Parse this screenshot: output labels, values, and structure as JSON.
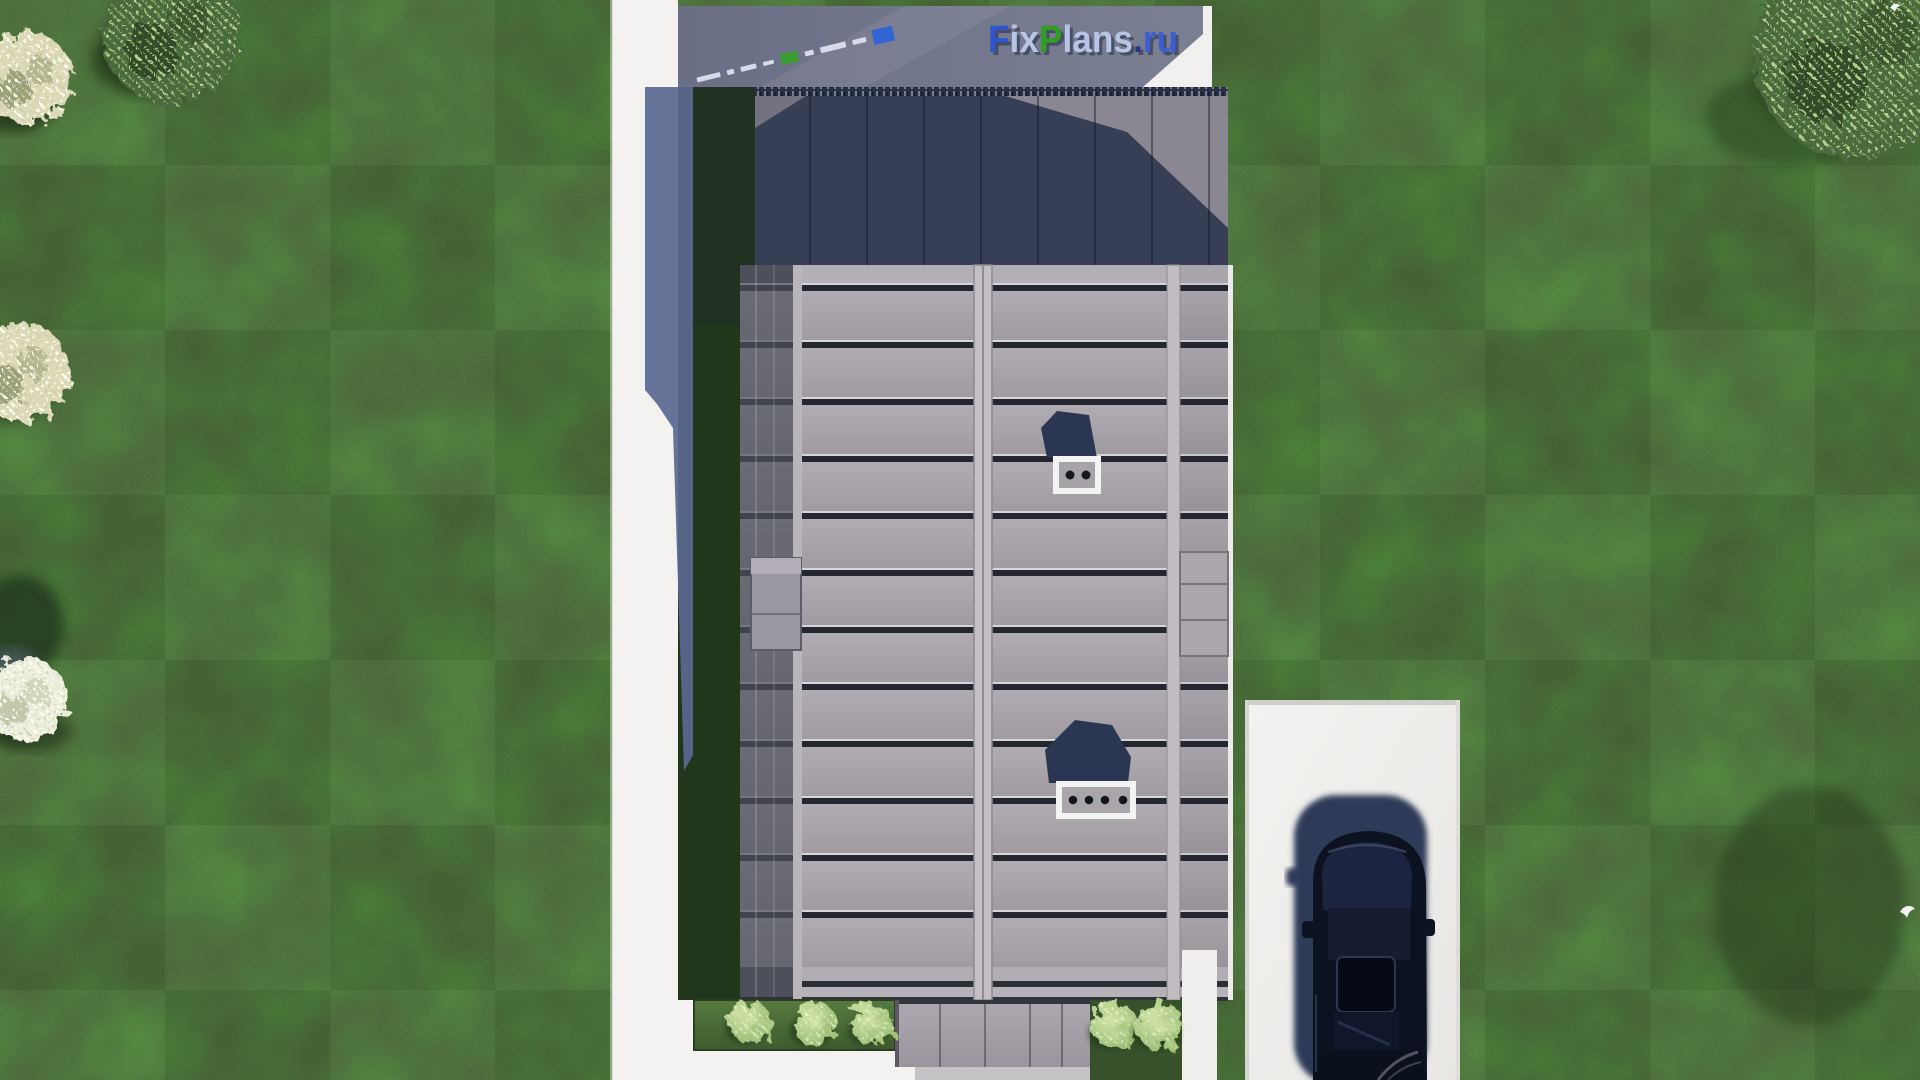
{
  "watermark": {
    "text": "FixPlans.ru",
    "segments": [
      {
        "text": "F",
        "color": "#2e55cc"
      },
      {
        "text": "ix",
        "color": "#b8c4e4"
      },
      {
        "text": "P",
        "color": "#2f9e22"
      },
      {
        "text": "lans",
        "color": "#b8c4e4"
      },
      {
        "text": ".",
        "color": "#26387d"
      },
      {
        "text": "ru",
        "color": "#3d5ed0"
      }
    ]
  },
  "mini_watermark": {
    "dashes": [
      {
        "w": 24,
        "h": 5,
        "color": "#dde4f2"
      },
      {
        "w": 7,
        "h": 5,
        "color": "#dde4f2"
      },
      {
        "w": 16,
        "h": 5,
        "color": "#dde4f2"
      },
      {
        "w": 11,
        "h": 4,
        "color": "#dde4f2"
      },
      {
        "w": 18,
        "h": 11,
        "color": "#3aa02c"
      },
      {
        "w": 9,
        "h": 5,
        "color": "#dde4f2"
      },
      {
        "w": 26,
        "h": 6,
        "color": "#dde4f2"
      },
      {
        "w": 14,
        "h": 5,
        "color": "#dde4f2"
      },
      {
        "w": 21,
        "h": 15,
        "color": "#2b62d9"
      }
    ]
  },
  "scene": {
    "type": "aerial-house-render",
    "counts": {
      "trees": 5,
      "shrubs": 5,
      "birds": 2,
      "roof_vents": 2,
      "cars": 1
    },
    "objects": {
      "lawn": "dark green lawn with mowing checker",
      "walk_path": "white concrete path (left and bottom)",
      "terrace": "shaded grey-blue terrace strip (top)",
      "upper_roof": "dark navy standing-seam upper roof",
      "main_roof": "warm grey horizontal-panel main roof",
      "vent_small": "white-framed roof vent with 2 outlets",
      "vent_large": "white-framed roof vent with 4 outlets",
      "porch_canopy": "grey entrance canopy with steps",
      "driveway": "white concrete driveway (bottom right)",
      "car": "dark car parked facing down",
      "house_shadow": "blue cast shadow on path"
    },
    "palette": {
      "lawn_green": "#32462b",
      "garden_shade_green": "#22361b",
      "path_white": "#f3f2f0",
      "shadow_blue": "#5a6890",
      "roof_grey": "#a8a3a8",
      "upper_roof_navy": "#363f55",
      "terrace_grey": "#70748a",
      "driveway_white": "#f0efed",
      "car_black": "#0d1220",
      "bush_green": "#a4c47c"
    }
  }
}
